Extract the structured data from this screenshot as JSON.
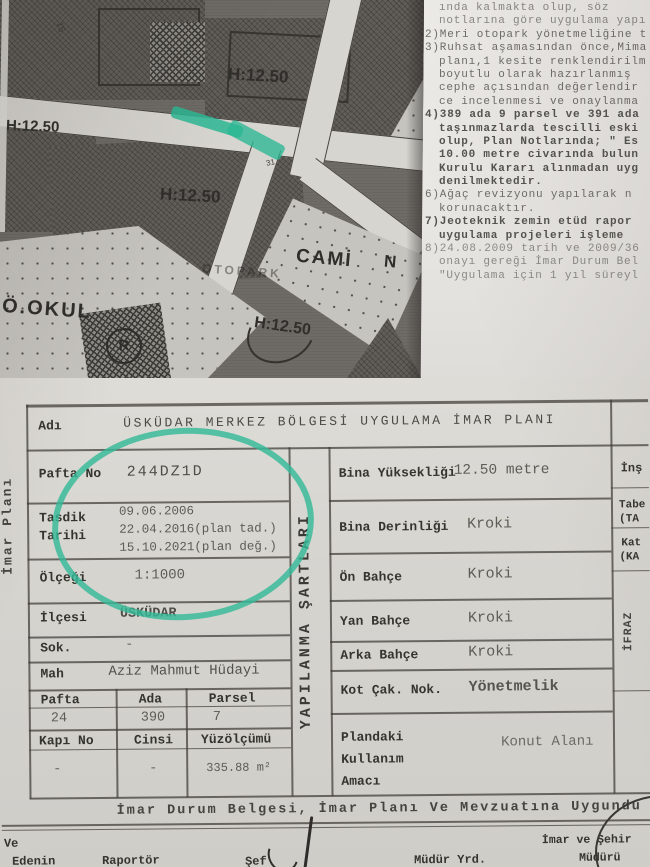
{
  "colors": {
    "highlighter_green": "#2fb795",
    "pen_dark": "#3a3834",
    "map_gray": "#6e6b66"
  },
  "map": {
    "scale": "1:1,000",
    "labels": {
      "h_top": "H:12.50",
      "h_left": "H:12.50",
      "h_mid": "H:12.50",
      "h_cami": "H:12.50",
      "cami": "CAMİ",
      "cami_n": "N",
      "okul": "Ö.OKUL",
      "otopark": "OTOPARK",
      "road_no": "31",
      "block_no": "15",
      "building_letter": "R"
    }
  },
  "notes": {
    "lines": [
      "ında kalmakta olup, söz",
      "notlarına göre uygulama yapı",
      "2)Meri otopark yönetmeliğine t",
      "3)Ruhsat aşamasından önce,Mima",
      "planı,1 kesite renklendirilm",
      "boyutlu  olarak hazırlanmış",
      "cephe açısından değerlendir",
      "ce incelenmesi ve onaylanma",
      "4)389 ada 9 parsel ve 391 ada",
      "taşınmazlarda tescilli eski",
      "olup, Plan Notlarında; \" Es",
      "10.00 metre civarında bulun",
      "Kurulu Kararı alınmadan uyg",
      "denilmektedir.",
      "6)Ağaç revizyonu yapılarak n",
      "korunacaktır.",
      "7)Jeoteknik zemin etüd rapor",
      "uygulama projeleri işleme",
      "8)24.08.2009 tarih ve 2009/36",
      "onayı gereği İmar Durum Bel",
      "\"Uygulama için 1 yıl süreyl"
    ]
  },
  "form": {
    "left_strip": "İmar Planı",
    "mid_strip": "YAPILANMA ŞARTLARI",
    "adi": {
      "label": "Adı",
      "value": "ÜSKÜDAR MERKEZ BÖLGESİ UYGULAMA İMAR PLANI"
    },
    "pafta_no": {
      "label": "Pafta No",
      "value": "244DZ1D"
    },
    "tasdik": {
      "label_line1": "Tasdik",
      "label_line2": "Tarihi",
      "date1": "09.06.2006",
      "date2": "22.04.2016(plan tad.)",
      "date3": "15.10.2021(plan değ.)"
    },
    "olcegi": {
      "label": "Ölçeği",
      "value": "1:1000"
    },
    "ilcesi": {
      "label": "İlçesi",
      "value": "ÜSKÜDAR"
    },
    "sok": {
      "label": "Sok.",
      "value": "-"
    },
    "mah": {
      "label": "Mah",
      "value": "Aziz Mahmut Hüdayi"
    },
    "pap": {
      "h1": "Pafta",
      "h2": "Ada",
      "h3": "Parsel",
      "v1": "24",
      "v2": "390",
      "v3": "7"
    },
    "kcy": {
      "h1": "Kapı No",
      "h2": "Cinsi",
      "h3": "Yüzölçümü",
      "v1": "-",
      "v2": "-",
      "v3": "335.88 m²"
    },
    "bina_yuksekligi": {
      "label": "Bina Yüksekliği",
      "value": "12.50 metre"
    },
    "bina_derinligi": {
      "label": "Bina Derinliği",
      "value": "Kroki"
    },
    "on_bahce": {
      "label": "Ön Bahçe",
      "value": "Kroki"
    },
    "yan_bahce": {
      "label": "Yan Bahçe",
      "value": "Kroki"
    },
    "arka_bahce": {
      "label": "Arka Bahçe",
      "value": "Kroki"
    },
    "kot_cak": {
      "label": "Kot Çak. Nok.",
      "value": "Yönetmelik"
    },
    "plandaki": {
      "label_line1": "Plandaki",
      "label_line2": "Kullanım",
      "label_line3": "Amacı",
      "value": "Konut Alanı"
    },
    "right_edge": {
      "r1": "İnş",
      "r2a": "Tabe",
      "r2b": "(TA",
      "r3a": "Kat",
      "r3b": "(KA",
      "ifraz": "İFRAZ"
    },
    "statement": "İmar Durum Belgesi, İmar Planı Ve Mevzuatına Uygundu",
    "signatures": {
      "left1": "Ve",
      "left2": "Edenin",
      "raportor": "Raportör",
      "sef": "Şef",
      "mudur_yrd": "Müdür Yrd.",
      "imar_sehir1": "İmar ve Şehir",
      "imar_sehir2": "Müdürü"
    }
  }
}
